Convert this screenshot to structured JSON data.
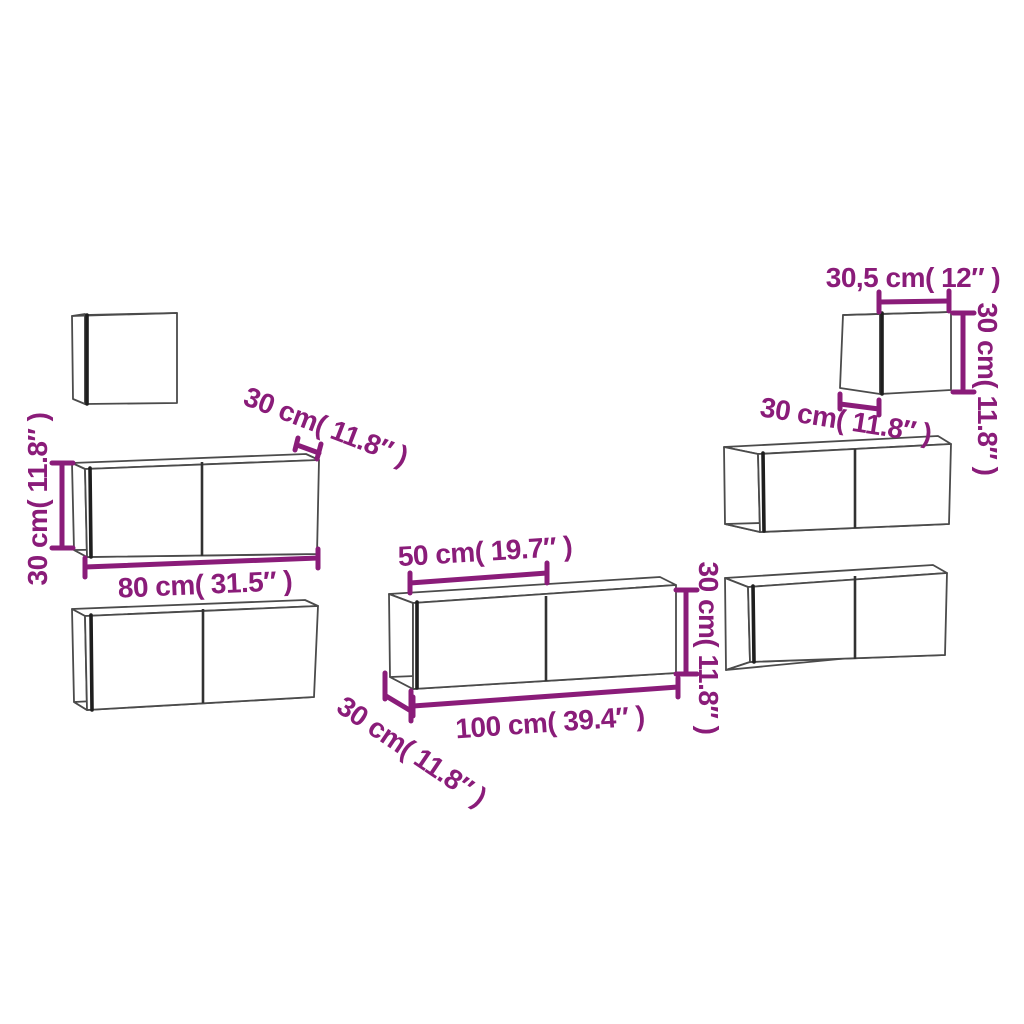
{
  "diagram": {
    "title": "tv-wall-cabinet-set-dimension-diagram",
    "background_color": "#ffffff",
    "accent_color": "#8a1c79",
    "outline_color": "#4b4b4b",
    "labels": {
      "left_height": "30 cm( 11.8″ )",
      "left_width": "80 cm( 31.5″ )",
      "left_depth": "30 cm( 11.8″ )",
      "middle_door_width": "50 cm( 19.7″ )",
      "middle_width": "100 cm( 39.4″ )",
      "middle_depth": "30 cm( 11.8″ )",
      "middle_height": "30 cm( 11.8″ )",
      "small_width": "30,5 cm( 12″ )",
      "small_height": "30 cm( 11.8″ )",
      "small_depth": "30 cm( 11.8″ )"
    },
    "dimensions": [
      {
        "id": "left-cabinet-height",
        "cm": "30",
        "inch": "11.8"
      },
      {
        "id": "left-cabinet-width",
        "cm": "80",
        "inch": "31.5"
      },
      {
        "id": "left-cabinet-depth",
        "cm": "30",
        "inch": "11.8"
      },
      {
        "id": "middle-cabinet-door-width",
        "cm": "50",
        "inch": "19.7"
      },
      {
        "id": "middle-cabinet-width",
        "cm": "100",
        "inch": "39.4"
      },
      {
        "id": "middle-cabinet-height",
        "cm": "30",
        "inch": "11.8"
      },
      {
        "id": "middle-cabinet-depth",
        "cm": "30",
        "inch": "11.8"
      },
      {
        "id": "small-cabinet-width",
        "cm": "30,5",
        "inch": "12"
      },
      {
        "id": "small-cabinet-height",
        "cm": "30",
        "inch": "11.8"
      },
      {
        "id": "small-cabinet-depth",
        "cm": "30",
        "inch": "11.8"
      }
    ],
    "cabinets": [
      "square-wall-cabinet-top-left",
      "wide-wall-cabinet-left-upper",
      "wide-wall-cabinet-left-lower",
      "wide-wall-cabinet-middle",
      "wide-wall-cabinet-right-upper",
      "wide-wall-cabinet-right-lower",
      "square-wall-cabinet-top-right"
    ]
  }
}
